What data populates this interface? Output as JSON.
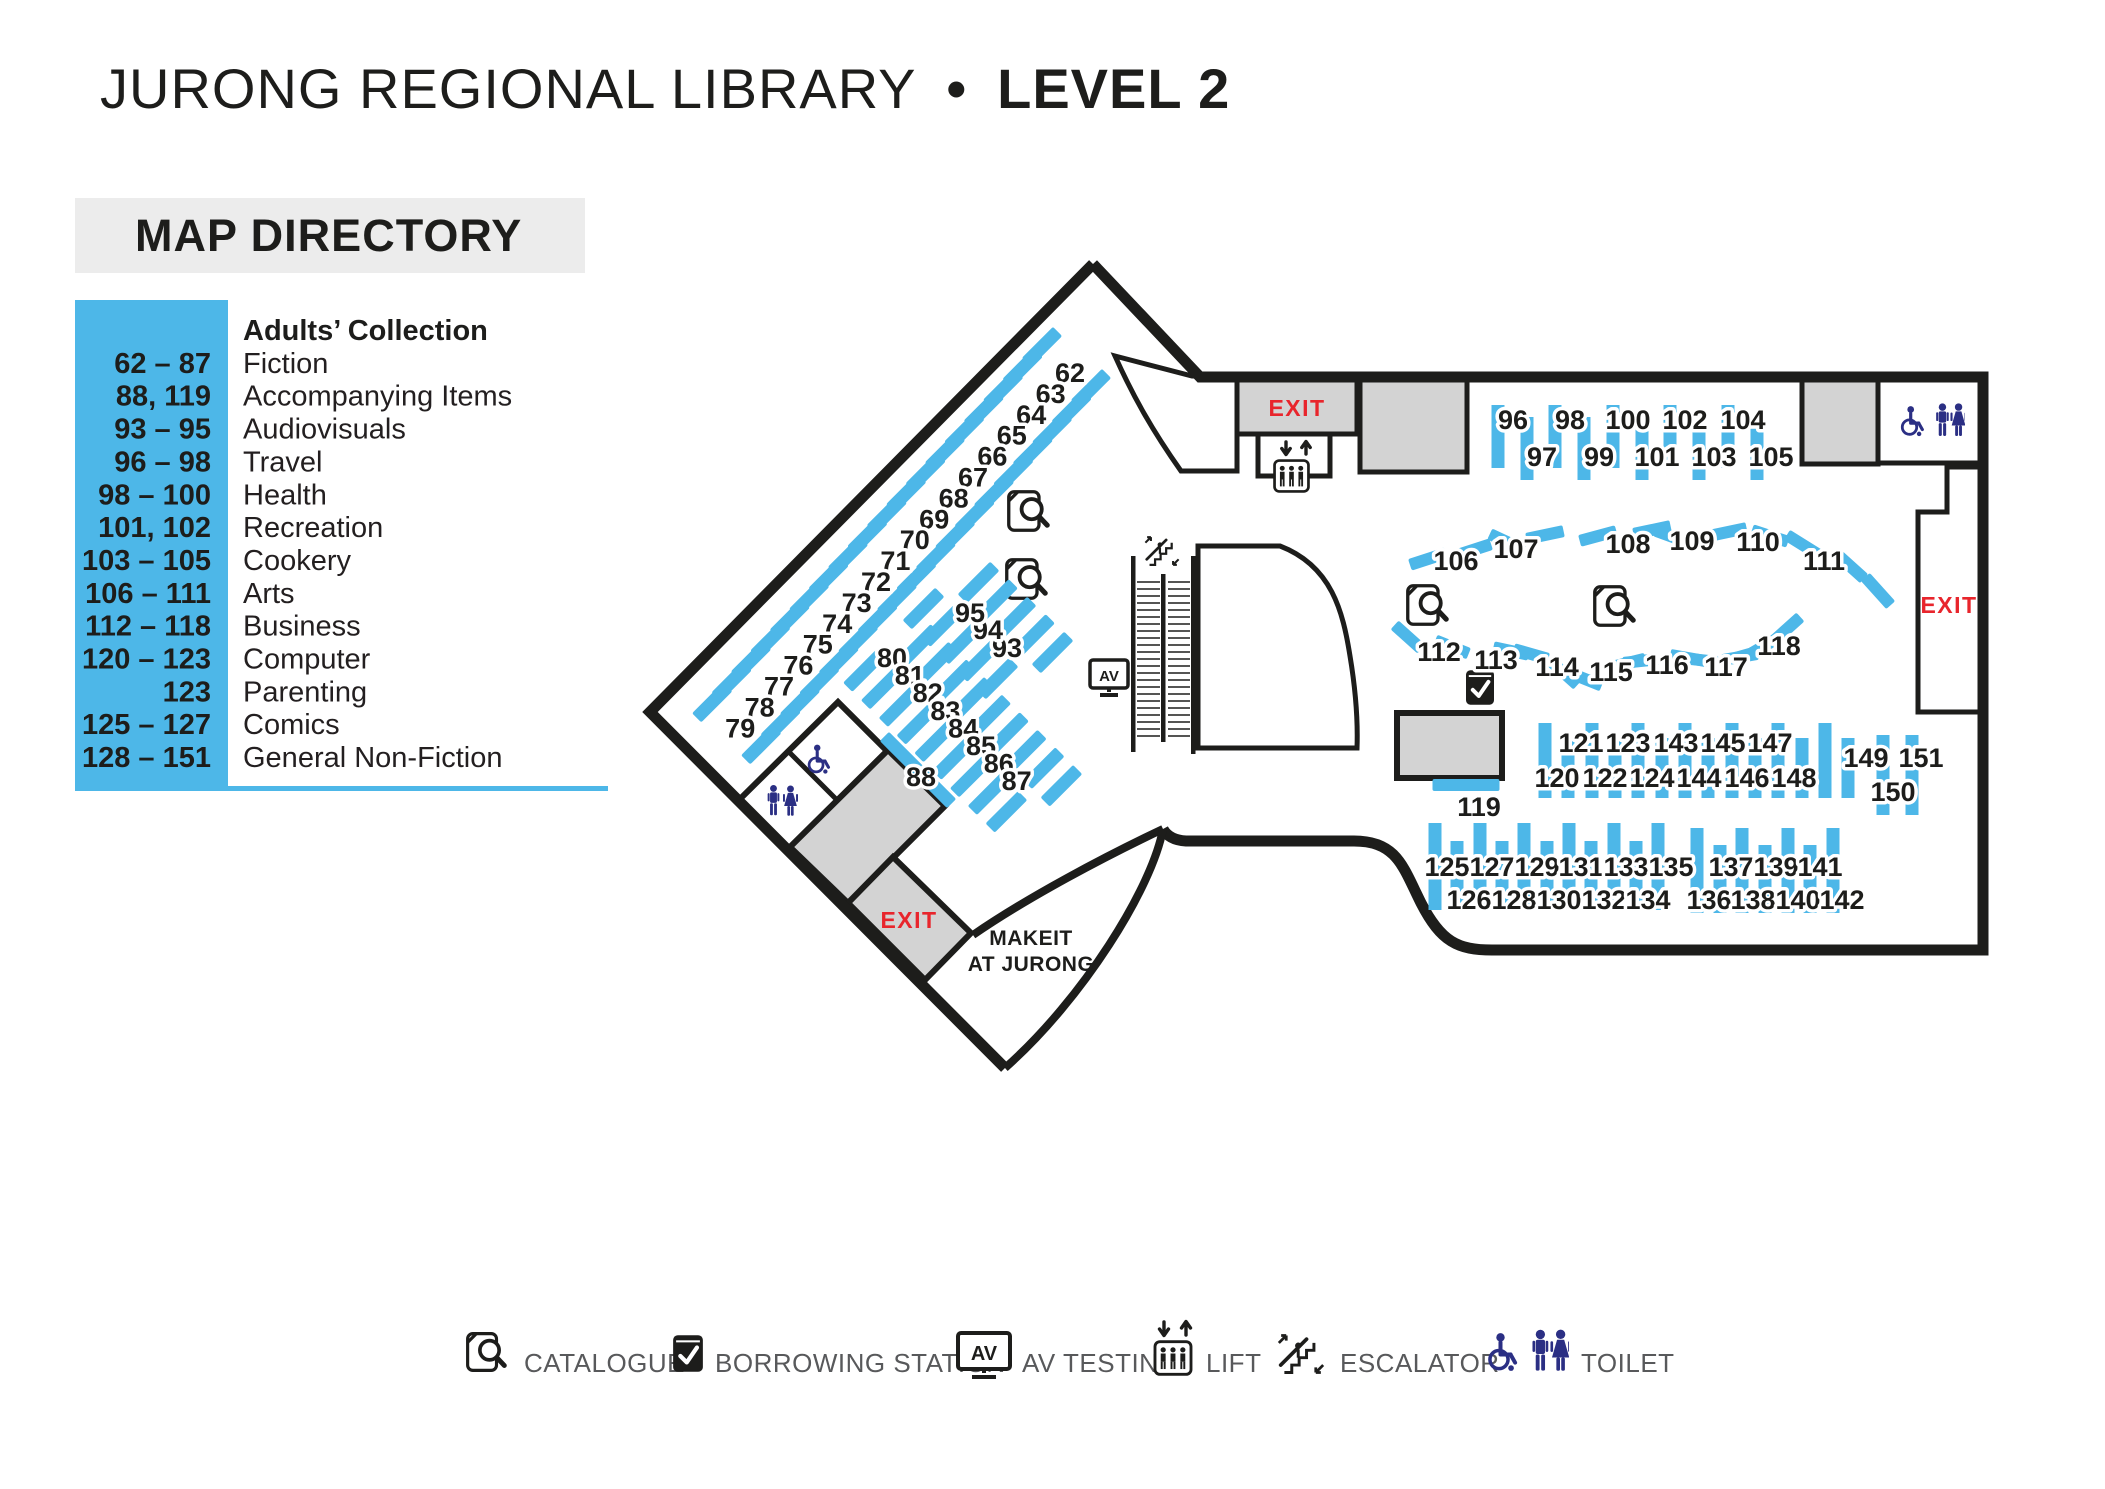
{
  "title": {
    "library": "JURONG REGIONAL LIBRARY",
    "separator": "•",
    "level": "LEVEL 2"
  },
  "directory": {
    "heading": "MAP DIRECTORY",
    "section_title": "Adults’ Collection",
    "entries": [
      {
        "range": "62 – 87",
        "label": "Fiction"
      },
      {
        "range": "88, 119",
        "label": "Accompanying Items"
      },
      {
        "range": "93 – 95",
        "label": "Audiovisuals"
      },
      {
        "range": "96 – 98",
        "label": "Travel"
      },
      {
        "range": "98 – 100",
        "label": "Health"
      },
      {
        "range": "101, 102",
        "label": "Recreation"
      },
      {
        "range": "103 – 105",
        "label": "Cookery"
      },
      {
        "range": "106 – 111",
        "label": "Arts"
      },
      {
        "range": "112 – 118",
        "label": "Business"
      },
      {
        "range": "120 – 123",
        "label": "Computer"
      },
      {
        "range": "123",
        "label": "Parenting"
      },
      {
        "range": "125 – 127",
        "label": "Comics"
      },
      {
        "range": "128 – 151",
        "label": "General Non-Fiction"
      }
    ]
  },
  "map": {
    "exit_label": "EXIT",
    "makeit_line1": "MAKEIT",
    "makeit_line2": "AT JURONG",
    "shelf_clusters": {
      "fiction_diagonal": [
        "62",
        "63",
        "64",
        "65",
        "66",
        "67",
        "68",
        "69",
        "70",
        "71",
        "72",
        "73",
        "74",
        "75",
        "76",
        "77",
        "78",
        "79"
      ],
      "fiction_ladder": [
        "80",
        "81",
        "82",
        "83",
        "84",
        "85",
        "86",
        "87"
      ],
      "accompanying": [
        "88"
      ],
      "audiovisuals": [
        "93",
        "94",
        "95"
      ],
      "travel_health_row": [
        "96",
        "97",
        "98",
        "99",
        "100",
        "101",
        "102",
        "103",
        "104",
        "105"
      ],
      "arts_wave": [
        "106",
        "107",
        "108",
        "109",
        "110",
        "111"
      ],
      "business_wave": [
        "112",
        "113",
        "114",
        "115",
        "116",
        "117",
        "118"
      ],
      "accompanying_2": [
        "119"
      ],
      "computer_row": [
        "120",
        "121",
        "122",
        "123",
        "124",
        "143",
        "144",
        "145",
        "146",
        "147",
        "148",
        "149",
        "150",
        "151"
      ],
      "comics_row": [
        "125",
        "126",
        "127",
        "128",
        "129",
        "130",
        "131",
        "132",
        "133",
        "134",
        "135",
        "136",
        "137",
        "138",
        "139",
        "140",
        "141",
        "142"
      ]
    }
  },
  "icons": {
    "av_label": "AV"
  },
  "legend": {
    "items": [
      {
        "icon": "catalogue-icon",
        "label": "CATALOGUE"
      },
      {
        "icon": "borrowing-station-icon",
        "label": "BORROWING STATION"
      },
      {
        "icon": "av-testing-icon",
        "label": "AV TESTING"
      },
      {
        "icon": "lift-icon",
        "label": "LIFT"
      },
      {
        "icon": "escalator-icon",
        "label": "ESCALATOR"
      },
      {
        "icon": "toilet-icon",
        "label": "TOILET"
      }
    ]
  },
  "colors": {
    "shelf_blue": "#4db7e8",
    "room_gray": "#d3d3d3",
    "wall_black": "#1d1d1b",
    "exit_red": "#e8252c",
    "toilet_navy": "#2b2f84",
    "legend_text": "#58595b",
    "directory_header_bg": "#ececec"
  }
}
